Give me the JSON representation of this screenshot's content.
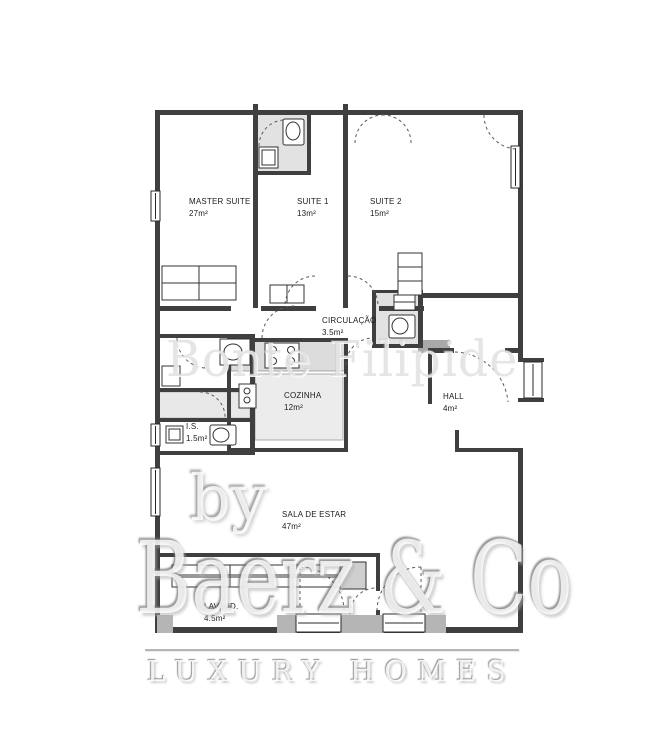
{
  "floor_plan": {
    "rooms": [
      {
        "id": "master-suite",
        "name": "MASTER SUITE",
        "area": "27m²"
      },
      {
        "id": "suite-1",
        "name": "SUITE 1",
        "area": "13m²"
      },
      {
        "id": "suite-2",
        "name": "SUITE 2",
        "area": "15m²"
      },
      {
        "id": "circulacao",
        "name": "CIRCULAÇÃO",
        "area": "3.5m²"
      },
      {
        "id": "cozinha",
        "name": "COZINHA",
        "area": "12m²"
      },
      {
        "id": "hall",
        "name": "HALL",
        "area": "4m²"
      },
      {
        "id": "is",
        "name": "I.S.",
        "area": "1.5m²"
      },
      {
        "id": "sala-de-estar",
        "name": "SALA DE ESTAR",
        "area": "47m²"
      },
      {
        "id": "lavandaria",
        "name": "LAVAND.",
        "area": "4.5m²"
      }
    ]
  },
  "watermarks": {
    "middle_text": "Bonte Filipide",
    "by_text": "by",
    "brand_text": "Baerz & Co",
    "tagline_text": "LUXURY HOMES"
  },
  "colors": {
    "background": "#ffffff",
    "wall": "#3f3f3f",
    "room_shading": "#e2e2e2",
    "kitchen_counter": "#dcdcdc",
    "kitchen_island": "#ececec",
    "window_pillar": "#b5b5b5",
    "watermark_gray": "#b5b5b5",
    "label_text": "#1c1c1c"
  },
  "icons": {
    "stove_icon": "four-burner-circles",
    "toilet_icon": "rect-with-oval-basin",
    "sink_icon": "rect-with-round-basin",
    "door_swing_icon": "dashed-quarter-arc",
    "window_icon": "double-line-rect"
  }
}
